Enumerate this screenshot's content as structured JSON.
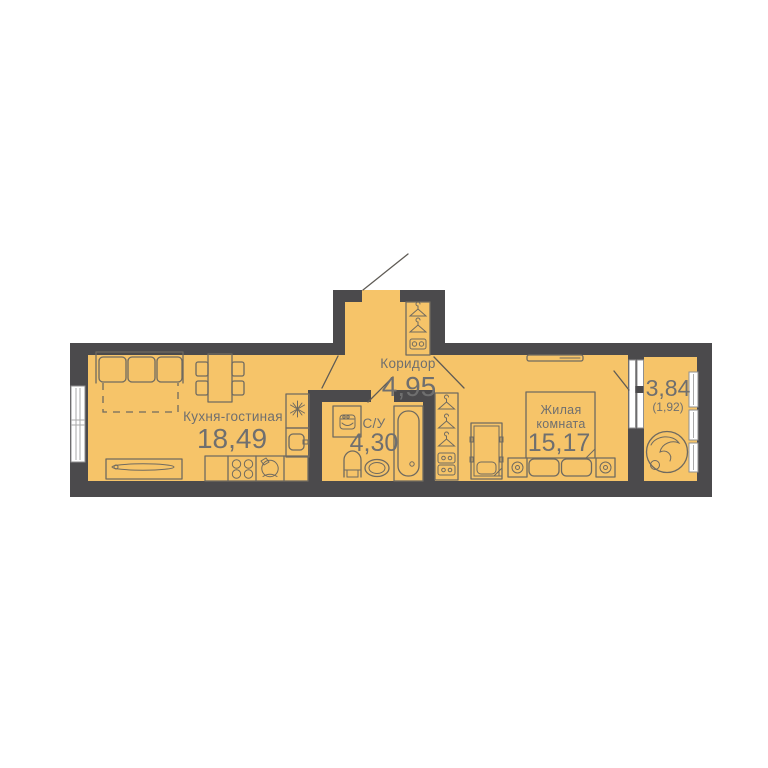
{
  "floorplan": {
    "rooms": {
      "kitchen_living": {
        "name": "Кухня-гостиная",
        "area": "18,49"
      },
      "corridor": {
        "name": "Коридор",
        "area": "4,95"
      },
      "bathroom": {
        "name": "С/У",
        "area": "4,30"
      },
      "bedroom": {
        "name_line1": "Жилая",
        "name_line2": "комната",
        "area": "15,17"
      },
      "balcony": {
        "area": "3,84",
        "area_reduced": "(1,92)"
      }
    },
    "colors": {
      "floor": "#f6c469",
      "wall": "#4b4a4c",
      "furniture_line": "#6f6a60",
      "label_text": "#6f6f6f",
      "window": "#ffffff",
      "window_frame": "#8f8f8f",
      "background": "#ffffff"
    },
    "icons": {
      "fridge-icon": "snowflake",
      "stove-icon": "four-burners",
      "kitchen-sink-icon": "bowl-with-tap",
      "hanger-icon": "clothes-hanger",
      "drawer-icon": "drawer-with-knobs",
      "washing-machine-icon": "front-load-drum",
      "nightstand-lamp-icon": "concentric-circles",
      "plant-icon": "potted-plant-top-view"
    }
  }
}
